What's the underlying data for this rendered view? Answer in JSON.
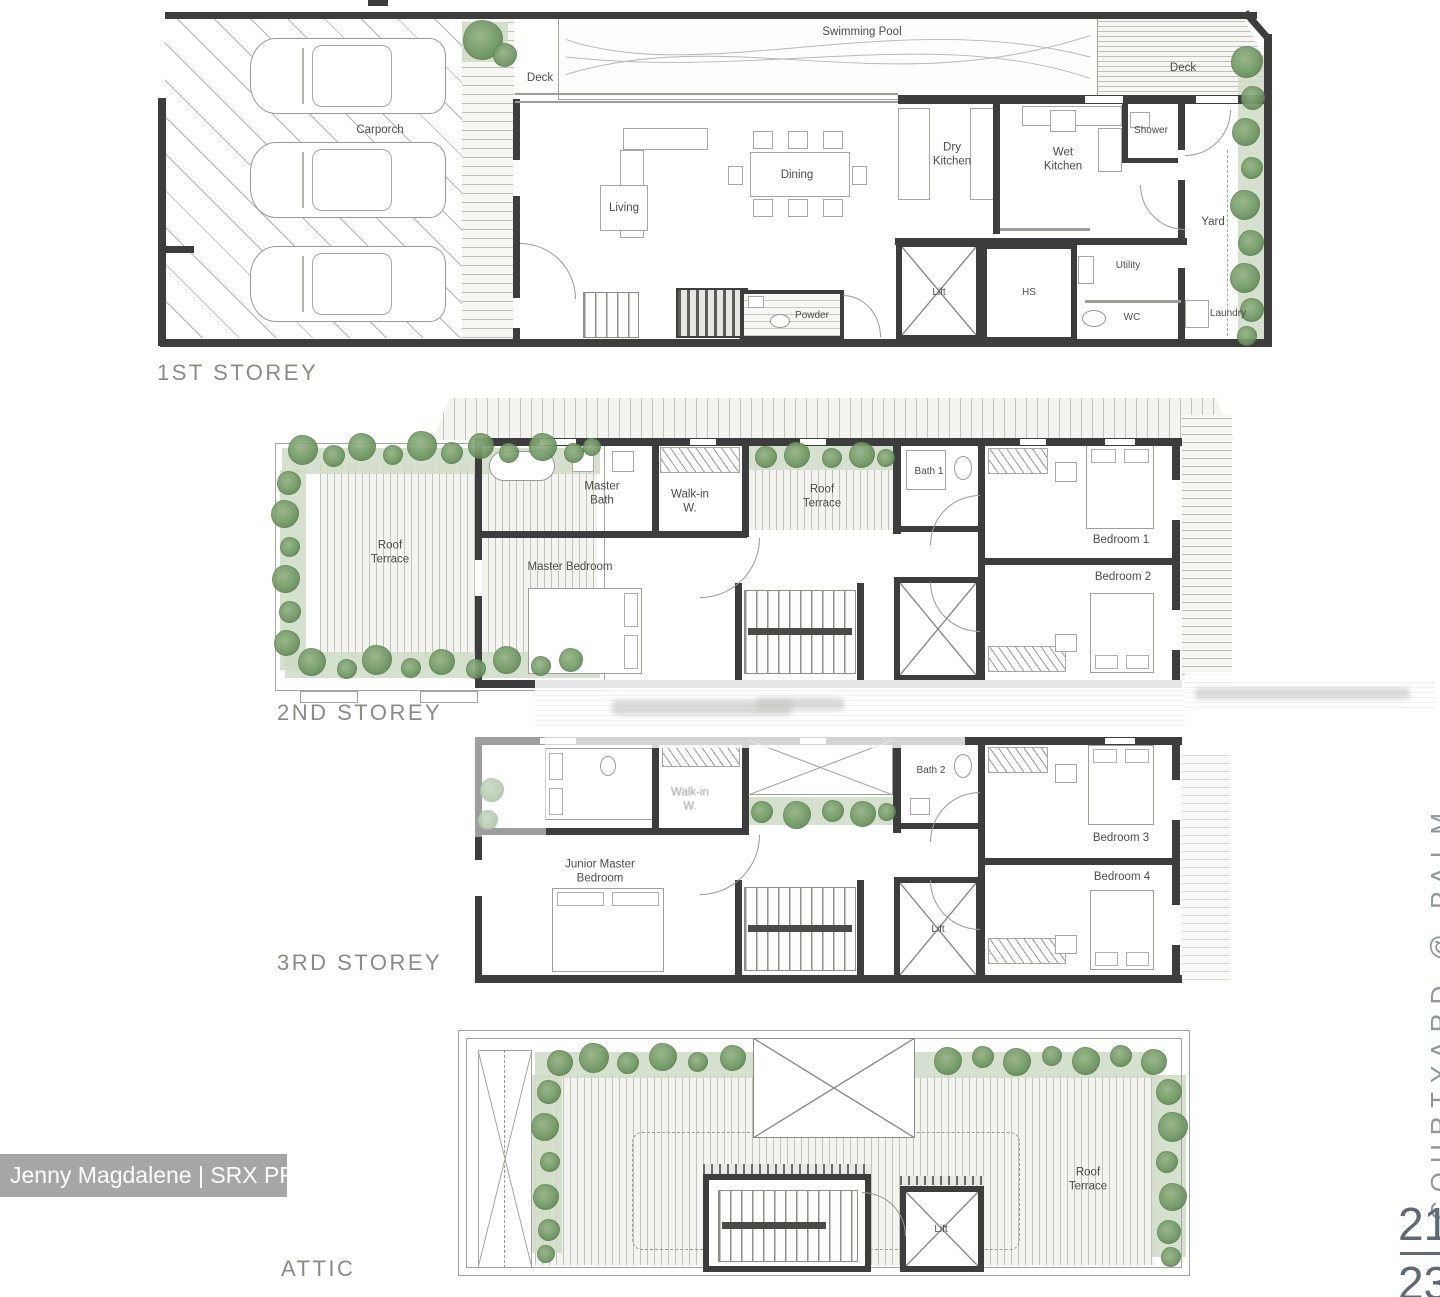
{
  "storeys": {
    "s1": {
      "label": "1ST STOREY",
      "rooms": {
        "swimming_pool": "Swimming Pool",
        "deck_left": "Deck",
        "deck_right": "Deck",
        "carporch": "Carporch",
        "living": "Living",
        "dining": "Dining",
        "dry_kitchen": "Dry\nKitchen",
        "wet_kitchen": "Wet\nKitchen",
        "shower": "Shower",
        "yard": "Yard",
        "powder": "Powder",
        "lift": "Lift",
        "hs": "HS",
        "utility": "Utility",
        "wc": "WC",
        "laundry": "Laundry"
      }
    },
    "s2": {
      "label": "2ND STOREY",
      "rooms": {
        "roof_terrace_left": "Roof\nTerrace",
        "master_bath": "Master\nBath",
        "walk_in": "Walk-in\nW.",
        "roof_terrace_mid": "Roof\nTerrace",
        "bath_1": "Bath 1",
        "bedroom_1": "Bedroom 1",
        "bedroom_2": "Bedroom 2",
        "master_bedroom": "Master Bedroom"
      }
    },
    "s3": {
      "label": "3RD STOREY",
      "rooms": {
        "walk_in": "Walk-in\nW.",
        "bath_2": "Bath 2",
        "bedroom_3": "Bedroom 3",
        "bedroom_4": "Bedroom 4",
        "junior_master_bedroom": "Junior Master\nBedroom",
        "lift": "Lift"
      }
    },
    "attic": {
      "label": "ATTIC",
      "rooms": {
        "roof_terrace": "Roof\nTerrace",
        "lift": "Lift"
      }
    }
  },
  "watermark": "Jenny Magdalene | SRX PROPERTY",
  "side_text": "COURTYARD @ PALM",
  "page_indicator": {
    "current": "21",
    "total": "23"
  }
}
